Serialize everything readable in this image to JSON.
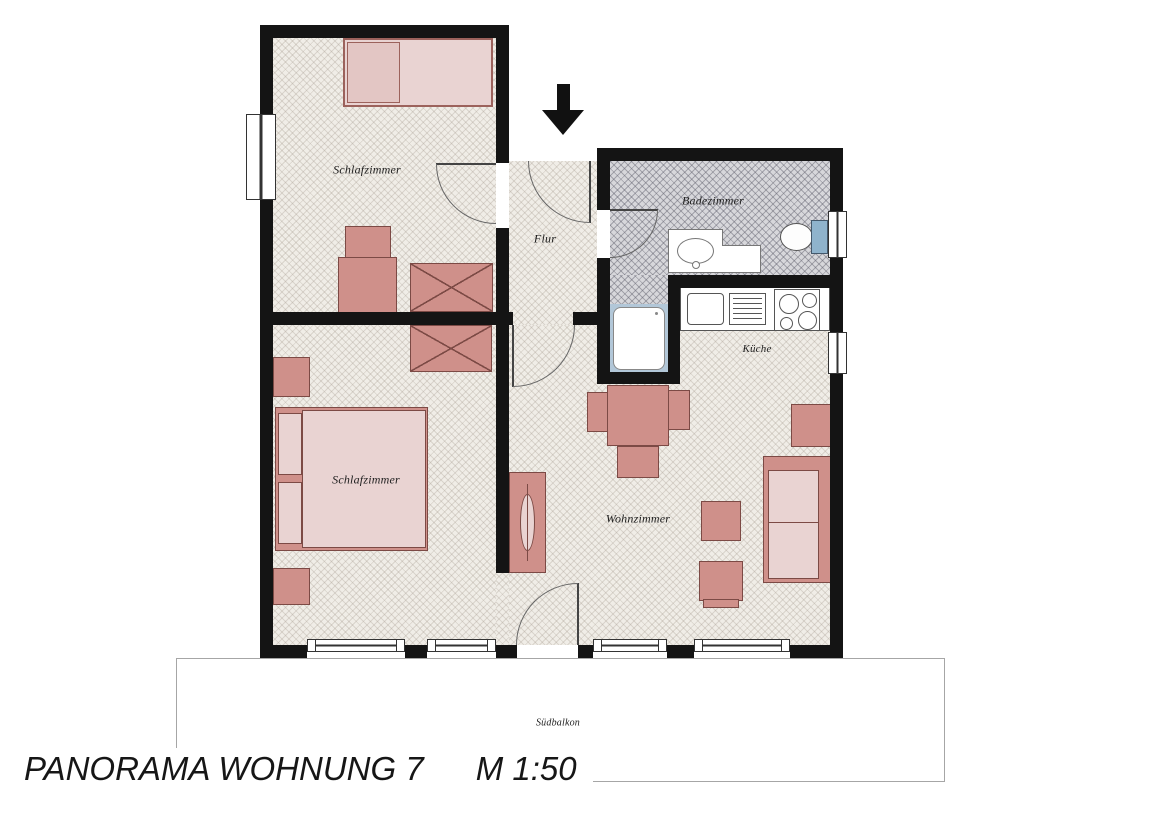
{
  "title": {
    "project": "PANORAMA WOHNUNG 7",
    "scale": "M 1:50"
  },
  "rooms": {
    "bedroom_top": {
      "label": "Schlafzimmer"
    },
    "hall": {
      "label": "Flur"
    },
    "bathroom": {
      "label": "Badezimmer"
    },
    "kitchen": {
      "label": "Küche"
    },
    "bedroom_bottom": {
      "label": "Schlafzimmer"
    },
    "living_room": {
      "label": "Wohnzimmer"
    },
    "balcony": {
      "label": "Südbalkon"
    }
  },
  "icons": {
    "entrance_arrow": "black arrow pointing down at apartment entrance door"
  },
  "furniture": {
    "bedroom_top": [
      "single-bed",
      "armchair",
      "wardrobe-x"
    ],
    "bedroom_bottom": [
      "double-bed",
      "nightstand",
      "nightstand",
      "wardrobe-x"
    ],
    "bathroom": [
      "vanity-with-sink",
      "toilet",
      "shower"
    ],
    "kitchen": [
      "sink-basin",
      "drainer",
      "stove-4-burners"
    ],
    "living_room": [
      "dining-table-with-chairs",
      "sideboard",
      "sofa",
      "armchair",
      "side-table",
      "side-table"
    ]
  },
  "colors": {
    "wall": "#141414",
    "floor": "#f0ede7",
    "bathroom_floor": "#d7d7db",
    "furniture_dark": "#cf908a",
    "furniture_light": "#e9d3d2",
    "furniture_outline": "#7c4a45",
    "shower_frame": "#b2c7d8",
    "toilet_cistern": "#8fb3cc",
    "balcony_outline": "#a6a6a6",
    "text": "#1d1d1d"
  }
}
